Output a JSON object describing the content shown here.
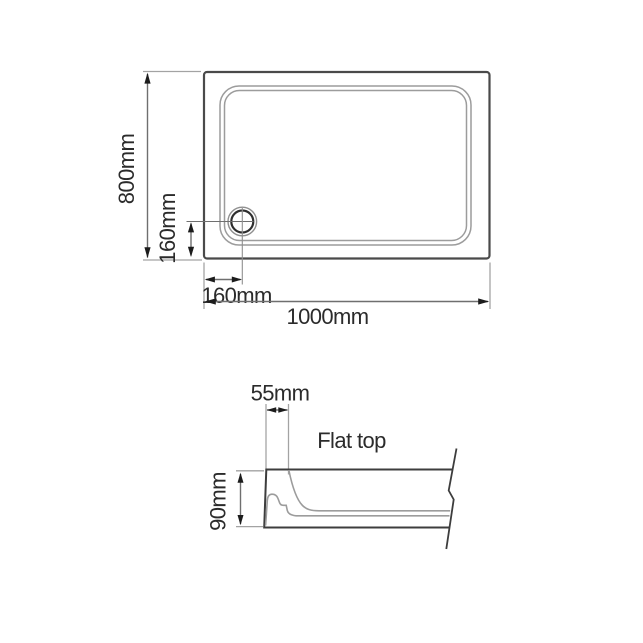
{
  "colors": {
    "background": "#ffffff",
    "outline": "#4a4a4a",
    "detail_line": "#9c9c9c",
    "dimension_line": "#6f6f6f",
    "arrowhead": "#1c1c1c",
    "text": "#2b2b2b"
  },
  "plan_view": {
    "height_dim": "800mm",
    "width_dim": "1000mm",
    "drain_offset_vertical_dim": "160mm",
    "drain_offset_horizontal_dim": "160mm"
  },
  "section_view": {
    "rim_width_dim": "55mm",
    "height_dim": "90mm",
    "top_label": "Flat top"
  }
}
